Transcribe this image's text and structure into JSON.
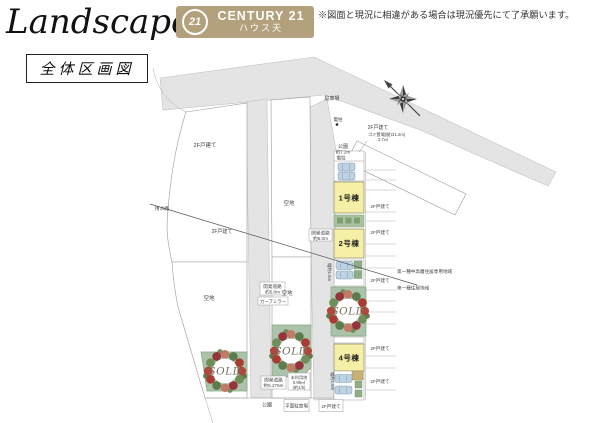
{
  "header": {
    "title": "Landscape",
    "subtitle": "全体区画図",
    "disclaimer": "※図面と現況に相違がある場合は現況優先にて了承願います。",
    "logo": {
      "circle_number": "21",
      "brand": "CENTURY 21",
      "office_name": "ハウス天"
    }
  },
  "map": {
    "buildings": [
      {
        "id": "bldg-1",
        "label": "1号棟",
        "status": "for-sale"
      },
      {
        "id": "bldg-2",
        "label": "2号棟",
        "status": "for-sale"
      },
      {
        "id": "bldg-4",
        "label": "4号棟",
        "status": "for-sale"
      }
    ],
    "sold_label": "SOLD",
    "sold_lot_count": 3,
    "labels": {
      "parking_lot": "駐車場",
      "utility_pole": "電柱",
      "park": "公園",
      "park_width": "約7.2m",
      "house_2f": "2F戸建て",
      "vacant": "空地",
      "waterway": "用水路",
      "dev_road": "開発道路",
      "road_width_5_0": "約5.0m",
      "road_width_5_275": "約5.275m",
      "curve_mirror": "カーブミラー",
      "unused_land": "未利用地",
      "unused_area": "0.98㎡",
      "unused_note": "(約1/5)",
      "zone_mid_high": "第一種中高層住居専用地域",
      "zone_residential": "第一種住居地域",
      "flat_parking": "平面駐車場",
      "trash_line1": "ゴミ置場(間口1.2m)",
      "trash_line2": "2.7㎡",
      "width_note": "幅約1.5m"
    }
  },
  "colors": {
    "logo_bg": "#b2a17c",
    "road": "#e4e4e4",
    "building_yellow": "#f6f0a6",
    "sold_green": "#abc3ab"
  }
}
